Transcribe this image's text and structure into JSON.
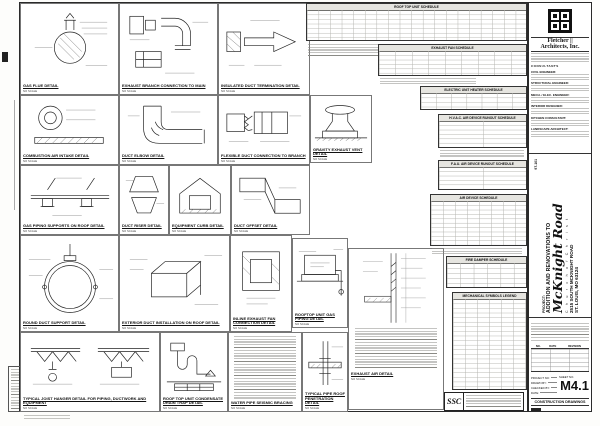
{
  "sheet": {
    "firm": {
      "name1": "Fletcher ||",
      "name2": "Architects, Inc.",
      "consultants_heading": "CONSULTANTS",
      "consultants": [
        "CIVIL ENGINEER:",
        "STRUCTURAL ENGINEER:",
        "MECH. / ELEC. ENGINEER:",
        "INTERIOR DESIGNER:",
        "KITCHEN CONSULTANT:",
        "LANDSCAPE ARCHITECT:"
      ]
    },
    "project": {
      "label": "PROJECT:",
      "line1": "ADDITION AND RENOVATIONS TO",
      "name": "McKnight Road",
      "name2": "C h u r c h   o f   C h r i s t",
      "address1": "2515 SOUTH MCKNIGHT ROAD",
      "address2": "ST. LOUIS, MO 63124",
      "comm_no": "97-101"
    },
    "revisions": {
      "no": "NO.",
      "date": "DATE",
      "rev": "REVISION"
    },
    "info": {
      "project_no": "PROJECT NO:",
      "drawn": "DRAWN BY:",
      "checked": "CHECKED BY:",
      "date": "DATE:",
      "sheet_no_label": "SHEET NO.",
      "sheet_no": "M4.1",
      "type": "CONSTRUCTION DRAWINGS"
    },
    "stamp": {
      "logo": "SSC"
    }
  },
  "schedules": [
    {
      "title": "ROOF TOP UNIT SCHEDULE"
    },
    {
      "title": "EXHAUST FAN SCHEDULE"
    },
    {
      "title": "ELECTRIC UNIT HEATER SCHEDULE"
    },
    {
      "title": "H.V.A.C. AIR DEVICE RUNOUT SCHEDULE"
    },
    {
      "title": "F.A.U. AIR DEVICE RUNOUT SCHEDULE"
    },
    {
      "title": "AIR DEVICE SCHEDULE"
    },
    {
      "title": "FIRE DAMPER SCHEDULE"
    },
    {
      "title": "MECHANICAL SYMBOLS LEGEND"
    }
  ],
  "details": [
    {
      "title": "GAS FLUE DETAIL",
      "scale": "NO SCALE"
    },
    {
      "title": "EXHAUST BRANCH CONNECTION TO MAIN",
      "scale": "NO SCALE"
    },
    {
      "title": "INSULATED DUCT TERMINATION DETAIL",
      "scale": "NO SCALE"
    },
    {
      "title": "COMBUSTION AIR INTAKE DETAIL",
      "scale": "NO SCALE"
    },
    {
      "title": "DUCT ELBOW DETAIL",
      "scale": "NO SCALE"
    },
    {
      "title": "FLEXIBLE DUCT CONNECTION TO BRANCH",
      "scale": "NO SCALE"
    },
    {
      "title": "GRAVITY EXHAUST VENT DETAIL",
      "scale": "NO SCALE"
    },
    {
      "title": "GAS PIPING SUPPORTS ON ROOF DETAIL",
      "scale": "NO SCALE"
    },
    {
      "title": "DUCT RISER DETAIL",
      "scale": "NO SCALE"
    },
    {
      "title": "EQUIPMENT CURB DETAIL",
      "scale": "NO SCALE"
    },
    {
      "title": "DUCT OFFSET DETAIL",
      "scale": "NO SCALE"
    },
    {
      "title": "ROUND DUCT SUPPORT DETAIL",
      "scale": "NO SCALE"
    },
    {
      "title": "EXTERIOR DUCT INSTALLATION ON ROOF DETAIL",
      "scale": "NO SCALE"
    },
    {
      "title": "INLINE EXHAUST FAN CONNECTION DETAIL",
      "scale": "NO SCALE"
    },
    {
      "title": "ROOFTOP UNIT GAS PIPING DETAIL",
      "scale": "NO SCALE"
    },
    {
      "title": "EXHAUST AIR DETAIL",
      "scale": "NO SCALE"
    },
    {
      "title": "TYPICAL JOIST HANGER DETAIL FOR PIPING, DUCTWORK AND EQUIPMENT",
      "scale": "NO SCALE"
    },
    {
      "title": "ROOF TOP UNIT CONDENSATE DRAIN TRAP DETAIL",
      "scale": "NO SCALE"
    },
    {
      "title": "WATER PIPE SEISMIC BRACING",
      "scale": "NO SCALE"
    },
    {
      "title": "TYPICAL PIPE ROOF PENETRATION DETAIL",
      "scale": "NO SCALE"
    }
  ]
}
